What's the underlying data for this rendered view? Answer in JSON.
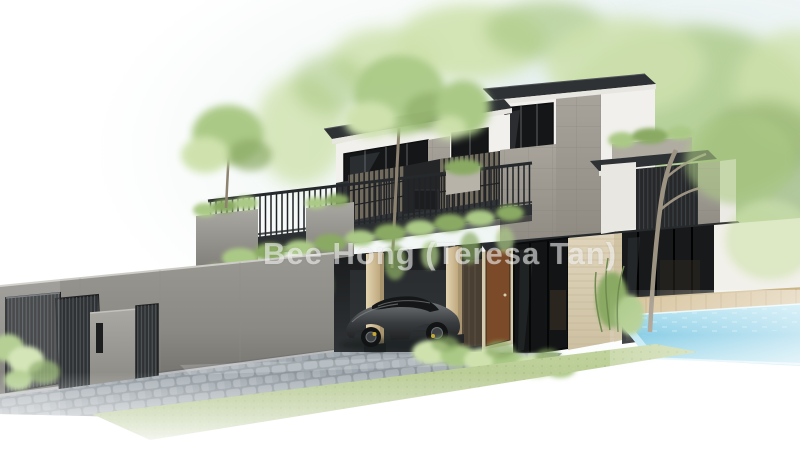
{
  "watermark": {
    "text": "Bee Hong (Teresa Tan)"
  },
  "colors": {
    "background": "#ffffff",
    "sky_wash": "#e4efeb",
    "foliage_light": "#cfe2ae",
    "foliage_mid": "#abc986",
    "foliage_dark": "#8aaa64",
    "roof_dark": "#2e3235",
    "wall_white": "#f1f0ec",
    "fascia_white": "#e8e6e1",
    "stone_light": "#a8a49c",
    "stone_dark": "#8f8b83",
    "panel_dark": "#2a2d2f",
    "louvre_slat": "#756f61",
    "glass_dark": "#141617",
    "travertine": "#d9cdb2",
    "door_wood": "#7b4a28",
    "column_wood": "#d8c7a4",
    "boundary_wall_top": "#9a9892",
    "boundary_wall_bottom": "#6e6c66",
    "gate_dark": "#2f3234",
    "cobble_light": "#aeb6bc",
    "cobble_dark": "#8e969c",
    "grass_green": "#a9bd82",
    "pool_light": "#aadeed",
    "pool_mid": "#6fc2e0",
    "deck_wood": "#d6c199",
    "car_body": "#55585b",
    "car_dark": "#1f2123",
    "caliper_yellow": "#c9a832",
    "watermark_color": "rgba(255,255,255,0.55)"
  }
}
